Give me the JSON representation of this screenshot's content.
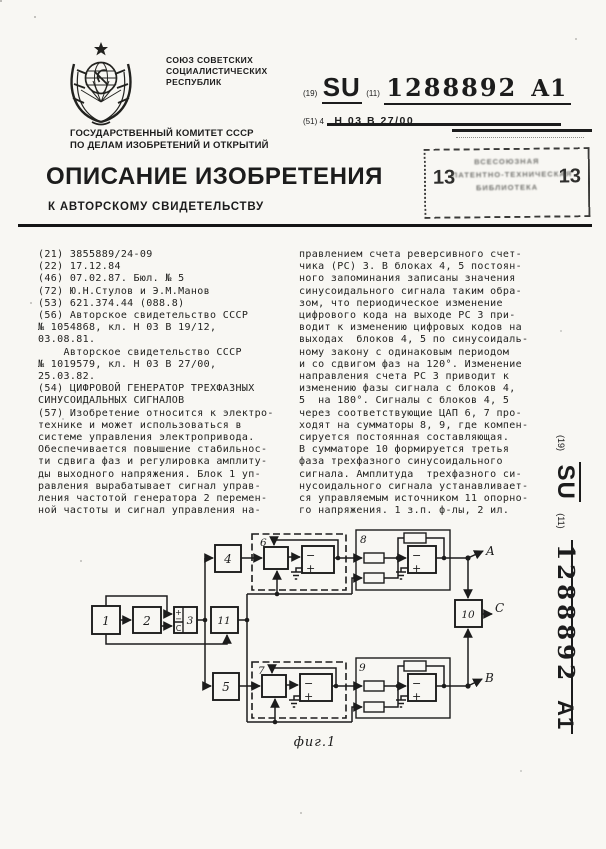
{
  "colors": {
    "ink": "#1c1c1c",
    "paper": "#f8f7f3"
  },
  "header": {
    "union_lines": [
      "СОЮЗ СОВЕТСКИХ",
      "СОЦИАЛИСТИЧЕСКИХ",
      "РЕСПУБЛИК"
    ],
    "committee_lines": [
      "ГОСУДАРСТВЕННЫЙ КОМИТЕТ СССР",
      "ПО ДЕЛАМ ИЗОБРЕТЕНИЙ И ОТКРЫТИЙ"
    ],
    "title": "ОПИСАНИЕ ИЗОБРЕТЕНИЯ",
    "subtitle": "К АВТОРСКОМУ СВИДЕТЕЛЬСТВУ"
  },
  "pub": {
    "country_label": "(19)",
    "country": "SU",
    "number_label": "(11)",
    "number": "1288892",
    "kind": "A1",
    "ipc_label": "(51) 4",
    "ipc": "Н 03 В 27/00"
  },
  "stamp": {
    "left": "13",
    "right": "13",
    "lines": [
      "ВСЕСОЮЗНАЯ",
      "ПАТЕНТНО-ТЕХНИЧЕСКАЯ",
      "БИБЛИОТЕКА"
    ]
  },
  "left_column_lines": [
    "(21) 3855889/24-09",
    "(22) 17.12.84",
    "(46) 07.02.87. Бюл. № 5",
    "(72) Ю.Н.Стулов и Э.М.Манов",
    "(53) 621.374.44 (088.8)",
    "(56) Авторское свидетельство СССР",
    "№ 1054868, кл. Н 03 В 19/12,",
    "03.08.81.",
    "    Авторское свидетельство СССР",
    "№ 1019579, кл. Н 03 В 27/00,",
    "25.03.82.",
    "(54) ЦИФРОВОЙ ГЕНЕРАТОР ТРЕХФАЗНЫХ",
    "СИНУСОИДАЛЬНЫХ СИГНАЛОВ",
    "(57) Изобретение относится к электро-",
    "технике и может использоваться в",
    "системе управления электропривода.",
    "Обеспечивается повышение стабильнос-",
    "ти сдвига фаз и регулировка амплиту-",
    "ды выходного напряжения. Блок 1 уп-",
    "равления вырабатывает сигнал управ-",
    "ления частотой генератора 2 перемен-",
    "ной частоты и сигнал управления на-"
  ],
  "right_column_lines": [
    "правлением счета реверсивного счет-",
    "чика (РС) 3. В блоках 4, 5 постоян-",
    "ного запоминания записаны значения",
    "синусоидального сигнала таким обра-",
    "зом, что периодическое изменение",
    "цифрового кода на выходе РС 3 при-",
    "водит к изменению цифровых кодов на",
    "выходах  блоков 4, 5 по синусоидаль-",
    "ному закону с одинаковым периодом",
    "и со сдвигом фаз на 120°. Изменение",
    "направления счета РС 3 приводит к",
    "изменению фазы сигнала с блоков 4,",
    "5  на 180°. Сигналы с блоков 4, 5",
    "через соответствующие ЦАП 6, 7 про-",
    "ходят на сумматоры 8, 9, где компен-",
    "сируется постоянная составляющая.",
    "В сумматоре 10 формируется третья",
    "фаза трехфазного синусоидального",
    "сигнала. Амплитуда  трехфазного си-",
    "нусоидального сигнала устанавливает-",
    "ся управляемым источником 11 опорно-",
    "го напряжения. 1 з.п. ф-лы, 2 ил."
  ],
  "figure": {
    "caption": "фиг.1",
    "labels": {
      "b1": "1",
      "b2": "2",
      "b3": "3",
      "b4": "4",
      "b5": "5",
      "b6": "6",
      "b7": "7",
      "b8": "8",
      "b9": "9",
      "b10": "10",
      "b11": "11",
      "plus": "+",
      "minus": "−",
      "clock": "C",
      "out_a": "A",
      "out_b": "B",
      "out_c": "C"
    }
  },
  "side_label": {
    "country_label": "(19)",
    "country": "SU",
    "number_label": "(11)",
    "number": "1288892",
    "kind": "A1"
  }
}
